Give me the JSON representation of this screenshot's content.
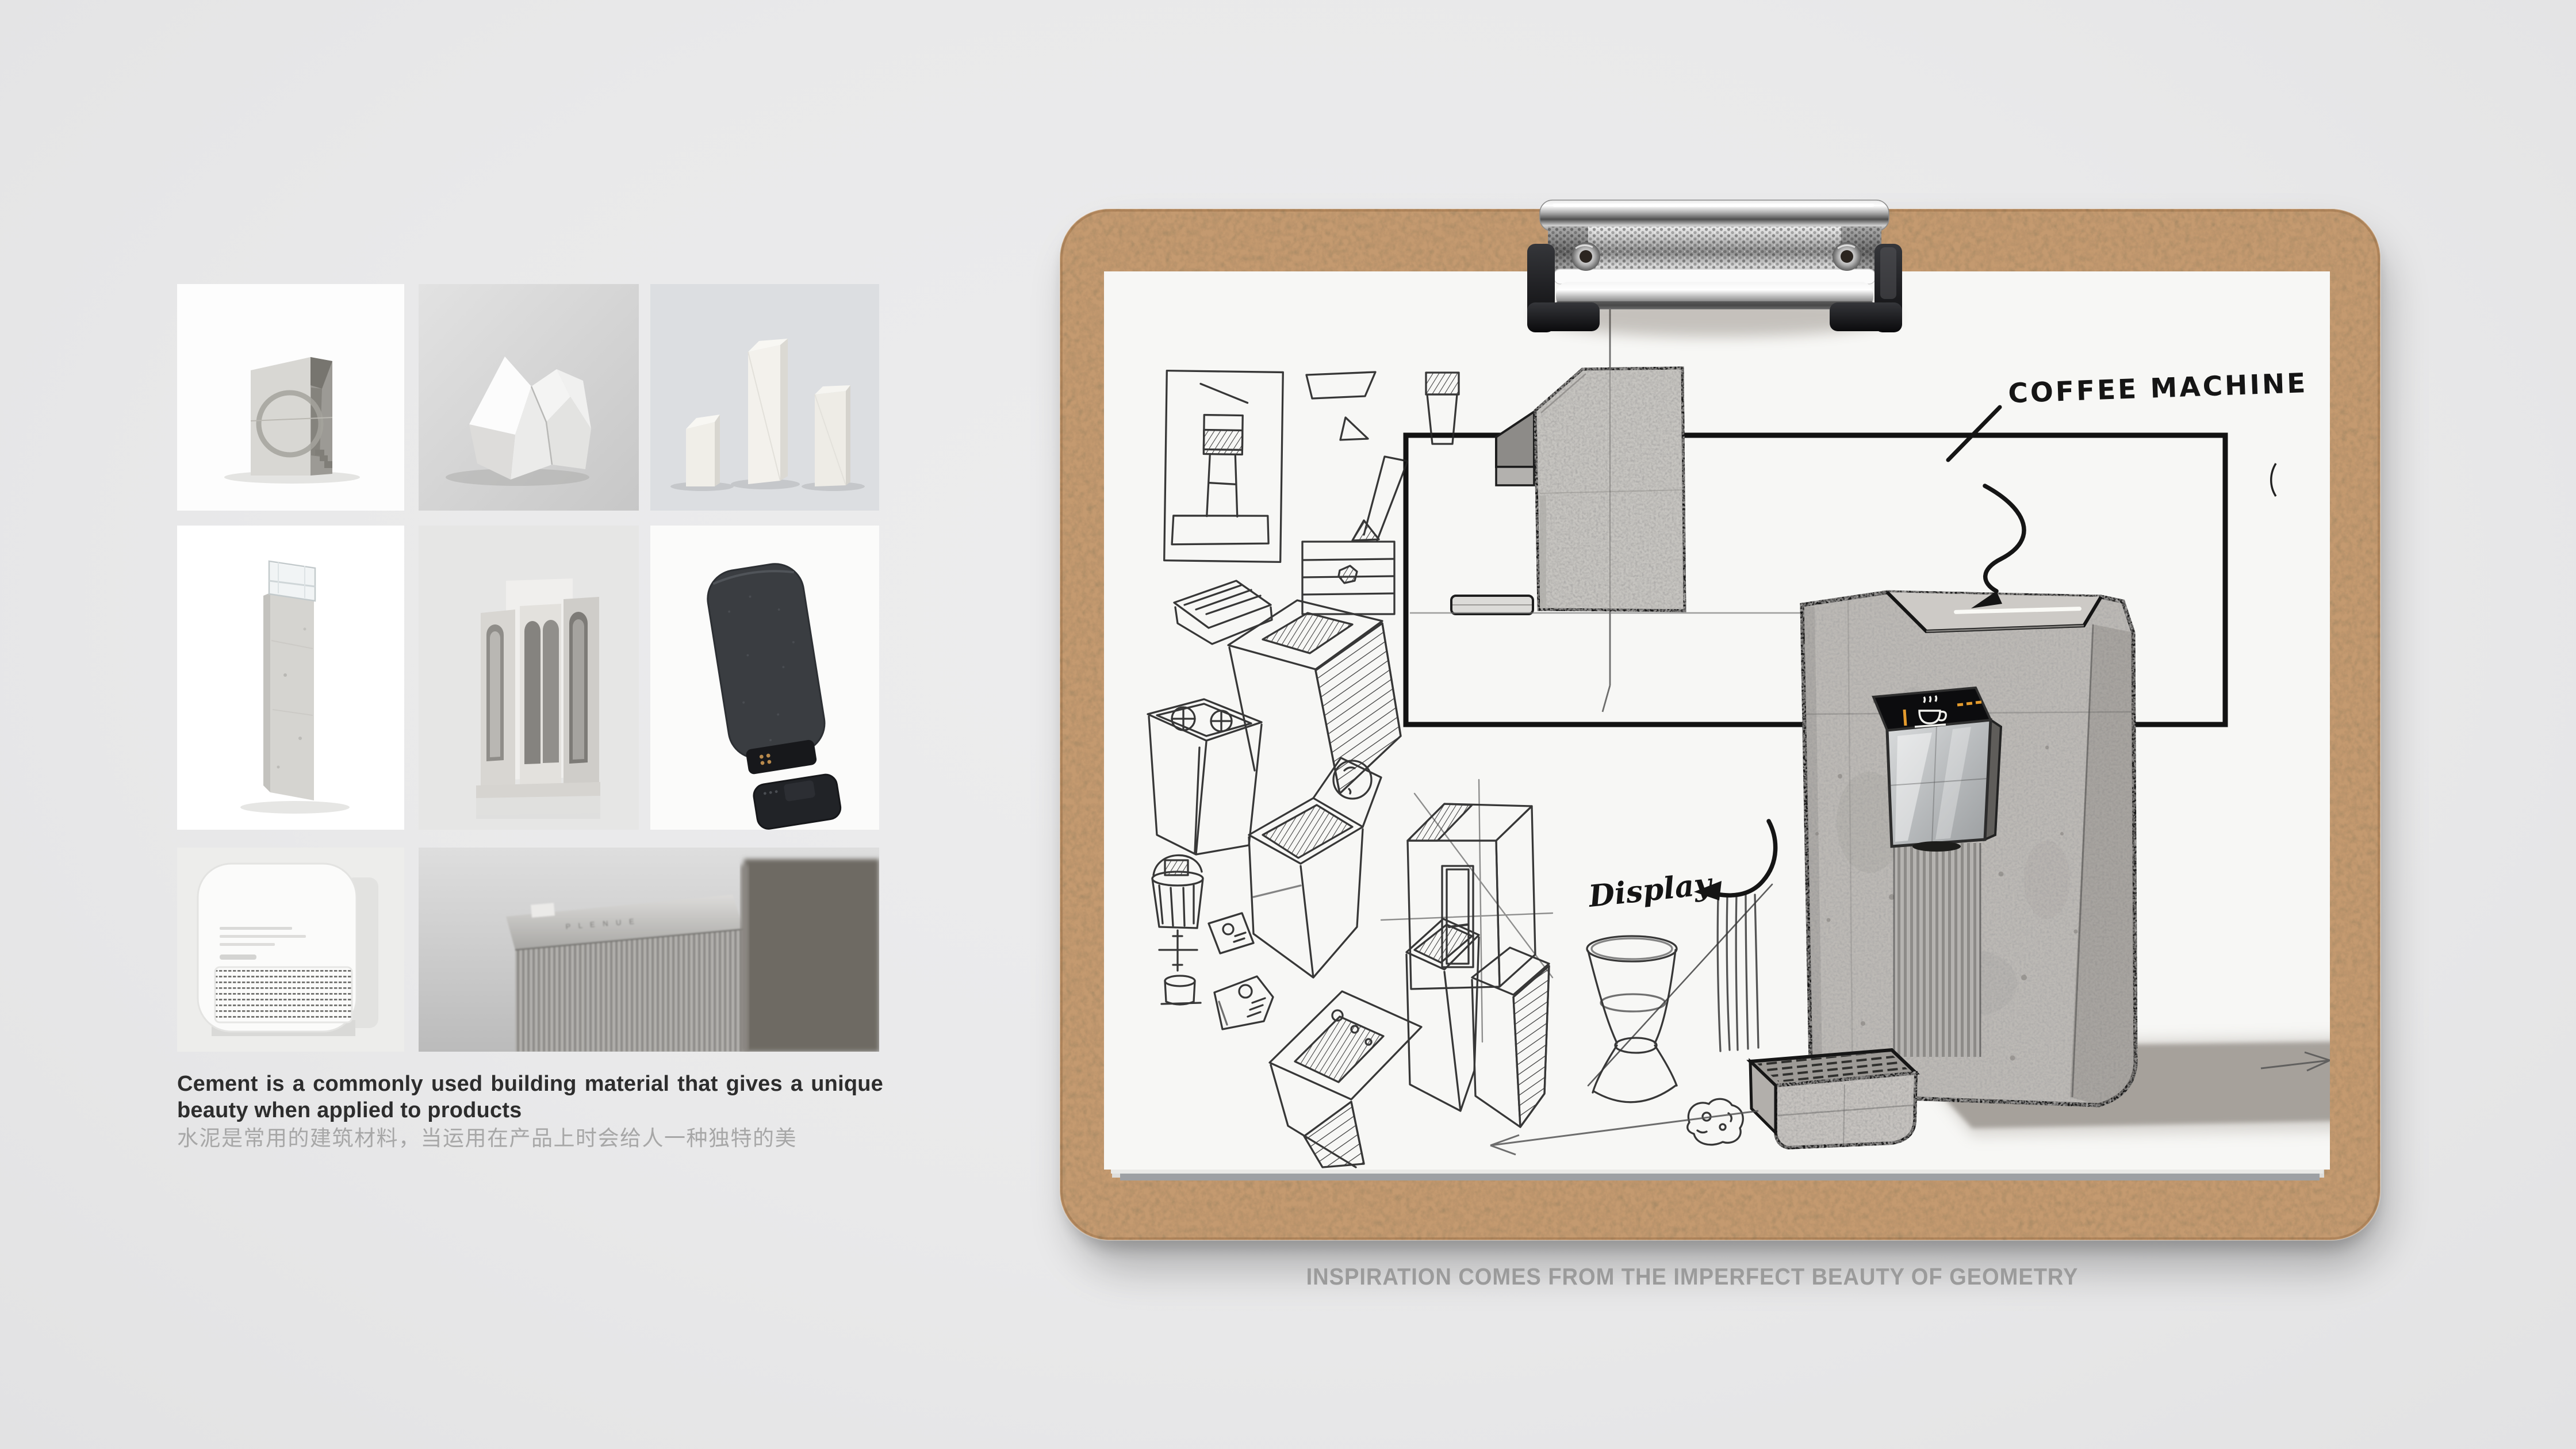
{
  "page": {
    "background": "#eaeaeb"
  },
  "moodboard": {
    "caption_en": "Cement is a commonly used building material that gives a unique beauty when applied to products",
    "caption_zh": "水泥是常用的建筑材料，当运用在产品上时会给人一种独特的美",
    "tiles": [
      {
        "name": "concrete-sculpture-photo",
        "alt": "concrete sculpture with circular cutout"
      },
      {
        "name": "faceted-white-form-photo",
        "alt": "white faceted geometric form"
      },
      {
        "name": "white-columns-photo",
        "alt": "three white angular columns"
      },
      {
        "name": "concrete-column-lamp-photo",
        "alt": "concrete column with clear acrylic cube top"
      },
      {
        "name": "concrete-arch-tower-photo",
        "alt": "concrete tower with arch cutouts"
      },
      {
        "name": "fabric-speaker-photo",
        "alt": "dark fabric speaker with detachable base"
      },
      {
        "name": "white-appliance-photo",
        "alt": "white rounded appliance with speaker grille"
      },
      {
        "name": "ribbed-device-photo",
        "alt": "close-up of ribbed grey audio device",
        "label": "P L E N U E"
      }
    ]
  },
  "clipboard": {
    "board_color": "#c49a70",
    "paper_color": "#f7f7f5",
    "labels": {
      "coffee_machine": "COFFEE MACHINE",
      "display": "Display"
    },
    "screen": {
      "accent_color": "#e49b2d",
      "icon": "coffee-cup-icon"
    }
  },
  "footer": {
    "caption": "INSPIRATION COMES FROM THE IMPERFECT BEAUTY OF GEOMETRY"
  },
  "colors": {
    "background": "#eaeaeb",
    "kraft_board": "#c49a70",
    "paper": "#f7f7f5",
    "ink": "#1c1c1c",
    "concrete": "#bcb9b5",
    "screen_accent": "#e49b2d",
    "caption_gray": "#9b9b9b"
  }
}
